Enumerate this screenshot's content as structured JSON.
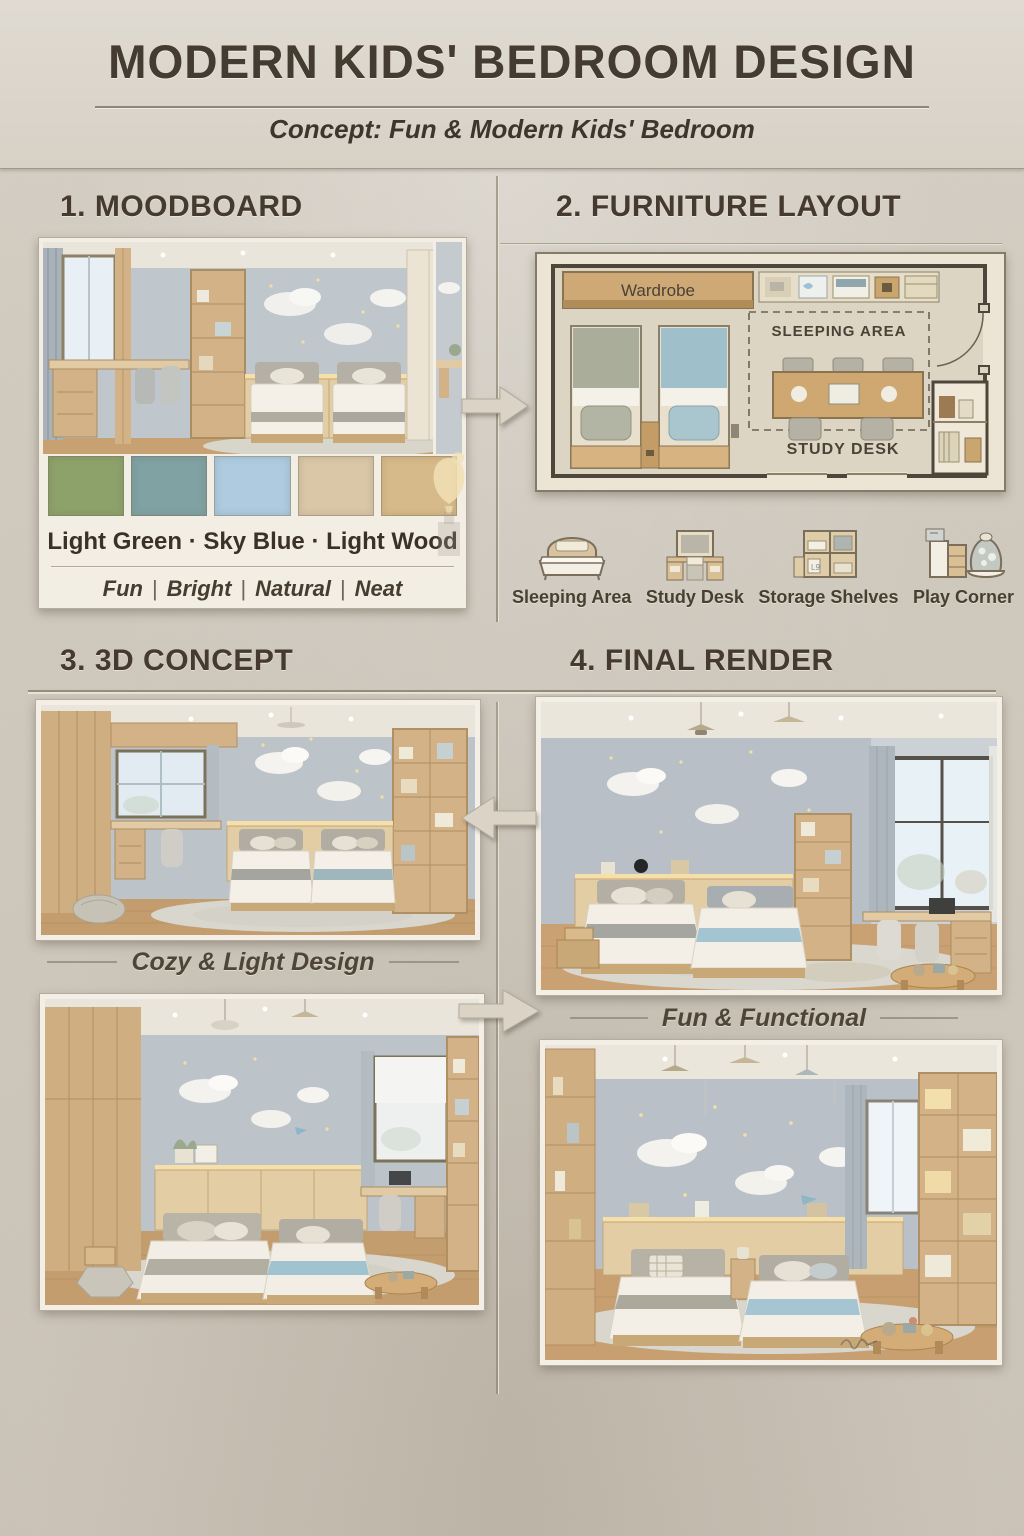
{
  "poster": {
    "title": "MODERN KIDS' BEDROOM DESIGN",
    "subtitle": "Concept: Fun & Modern Kids' Bedroom"
  },
  "sections": {
    "moodboard": "1. MOODBOARD",
    "furniture_layout": "2. FURNITURE LAYOUT",
    "concept_3d": "3. 3D CONCEPT",
    "final_render": "4. FINAL RENDER"
  },
  "moodboard": {
    "palette_label": "Light Green  ·  Sky Blue · Light Wood",
    "swatches": [
      {
        "name": "light-green",
        "hex": "#8da26b"
      },
      {
        "name": "sea-teal",
        "hex": "#80a2a3"
      },
      {
        "name": "sky-blue",
        "hex": "#aecbe0"
      },
      {
        "name": "light-wood",
        "hex": "#d9c7a7"
      },
      {
        "name": "warm-sand",
        "hex": "#d6ba8a"
      }
    ],
    "tagline": [
      "Fun",
      "Bright",
      "Natural",
      "Neat"
    ],
    "tagline_separator": "|"
  },
  "floor_plan": {
    "wardrobe_label": "Wardrobe",
    "sleeping_area_label": "SLEEPING AREA",
    "study_desk_label": "STUDY DESK"
  },
  "legend": {
    "items": [
      {
        "label": "Sleeping Area",
        "icon": "bed-icon"
      },
      {
        "label": "Study Desk",
        "icon": "desk-icon"
      },
      {
        "label": "Storage Shelves",
        "icon": "shelves-icon"
      },
      {
        "label": "Play Corner",
        "icon": "play-corner-icon"
      }
    ]
  },
  "captions": {
    "concept": "Cozy & Light Design",
    "final": "Fun & Functional"
  },
  "colors": {
    "paper": "#d2cbc0",
    "ink": "#453c31",
    "wood": "#d2b286",
    "wall_gray": "#b9c0c6",
    "sky_blue": "#aecbe0",
    "light_green": "#8da26b"
  }
}
